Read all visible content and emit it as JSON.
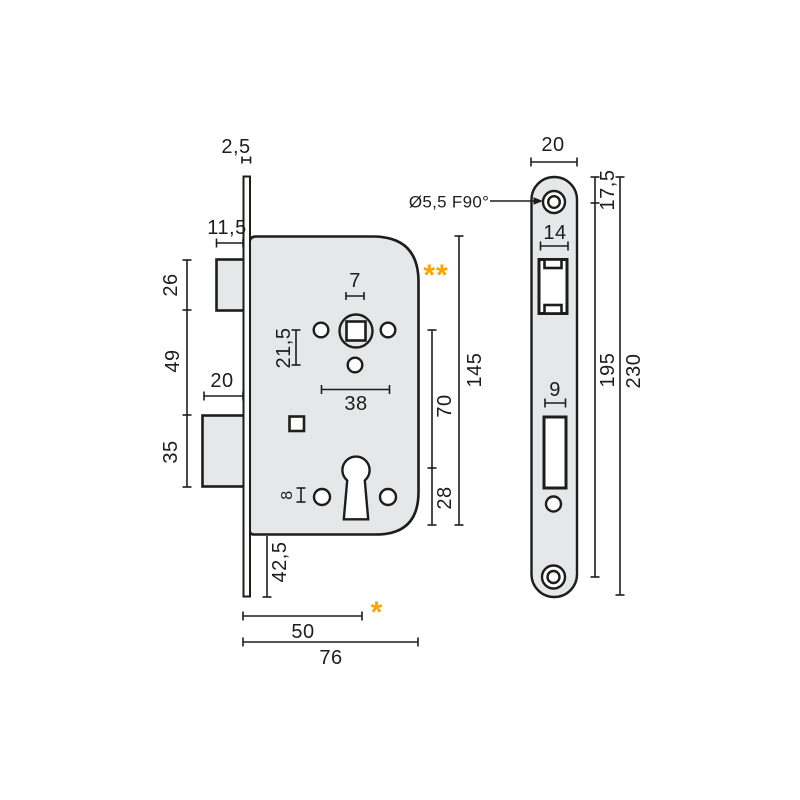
{
  "drawing": {
    "type": "technical-drawing",
    "subject": "mortise-lock-dimensions",
    "colors": {
      "line": "#1d1d1b",
      "fill": "#e5e7e9",
      "hole_fill": "#ffffff",
      "accent": "#f7a600"
    },
    "labels": {
      "plate_thickness": "2,5",
      "latch_protrusion": "11,5",
      "latch_height": "26",
      "latch_to_deadbolt": "49",
      "deadbolt_protrusion": "20",
      "deadbolt_height": "35",
      "spindle_hole_width": "7",
      "spindle_offset": "21,5",
      "hole_spacing": "38",
      "hole_diameter": "8",
      "case_bottom_offset": "42,5",
      "backset": "50",
      "case_depth": "76",
      "case_height": "145",
      "spindle_to_keyhole": "70",
      "keyhole_to_bottom": "28",
      "countersink_spec": "Ø5,5 F90°",
      "note_double": "**",
      "note_single": "*",
      "front_plate_width": "20",
      "front_top_to_screw": "17,5",
      "front_latch_cutout_width": "14",
      "front_screw_spacing": "195",
      "front_plate_height": "230",
      "front_bolt_cutout_width": "9"
    }
  }
}
